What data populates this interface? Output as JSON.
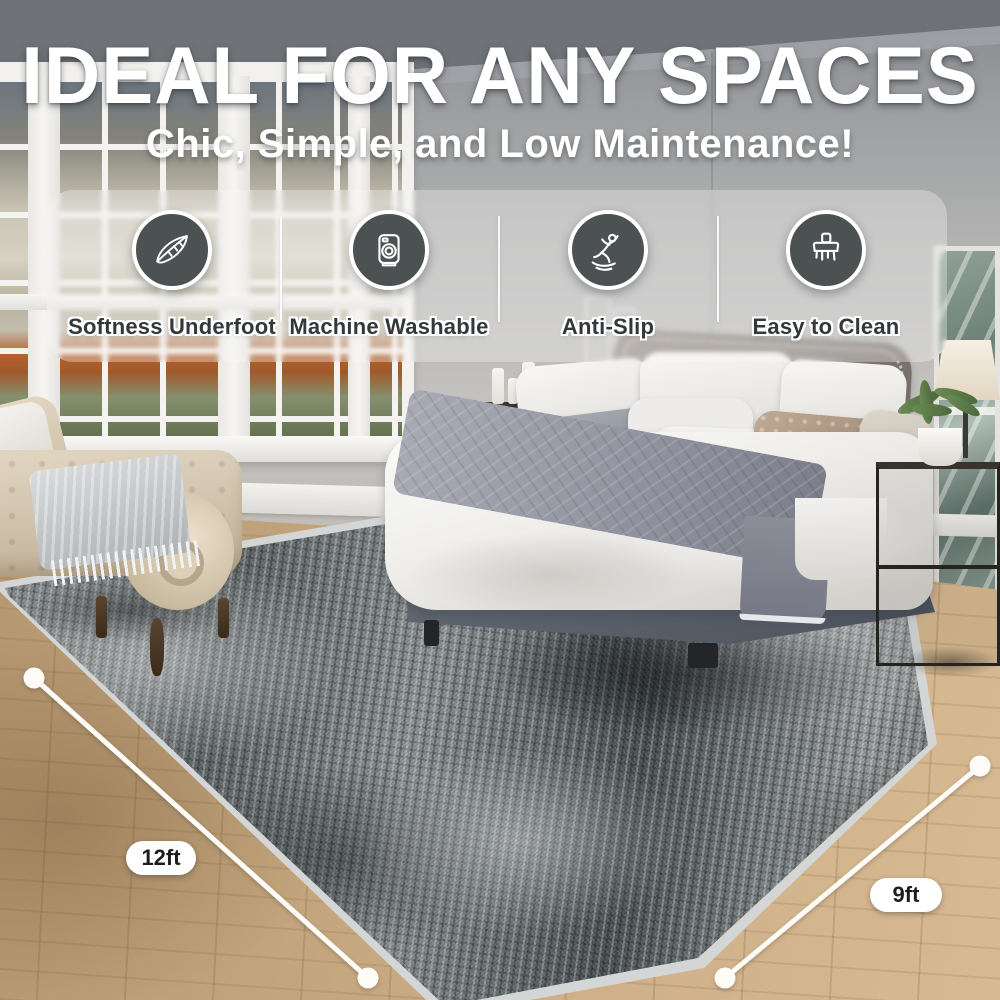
{
  "header": {
    "title": "IDEAL FOR ANY SPACES",
    "subtitle": "Chic, Simple, and Low Maintenance!"
  },
  "features": [
    {
      "icon": "feather-icon",
      "label": "Softness Underfoot"
    },
    {
      "icon": "washing-machine-icon",
      "label": "Machine Washable"
    },
    {
      "icon": "anti-slip-icon",
      "label": "Anti-Slip"
    },
    {
      "icon": "clean-brush-icon",
      "label": "Easy to Clean"
    }
  ],
  "rug_dimensions": {
    "length_label": "12ft",
    "width_label": "9ft"
  },
  "colors": {
    "feature_circle_bg": "#4C5152",
    "feature_circle_ring": "#FFFFFF",
    "feature_label_text": "#33383A",
    "headline_text": "#FFFFFF",
    "dimension_pill_bg": "#FFFFFF",
    "dimension_pill_text": "#1D1D1F",
    "measurement_line": "#FDFCF7"
  }
}
